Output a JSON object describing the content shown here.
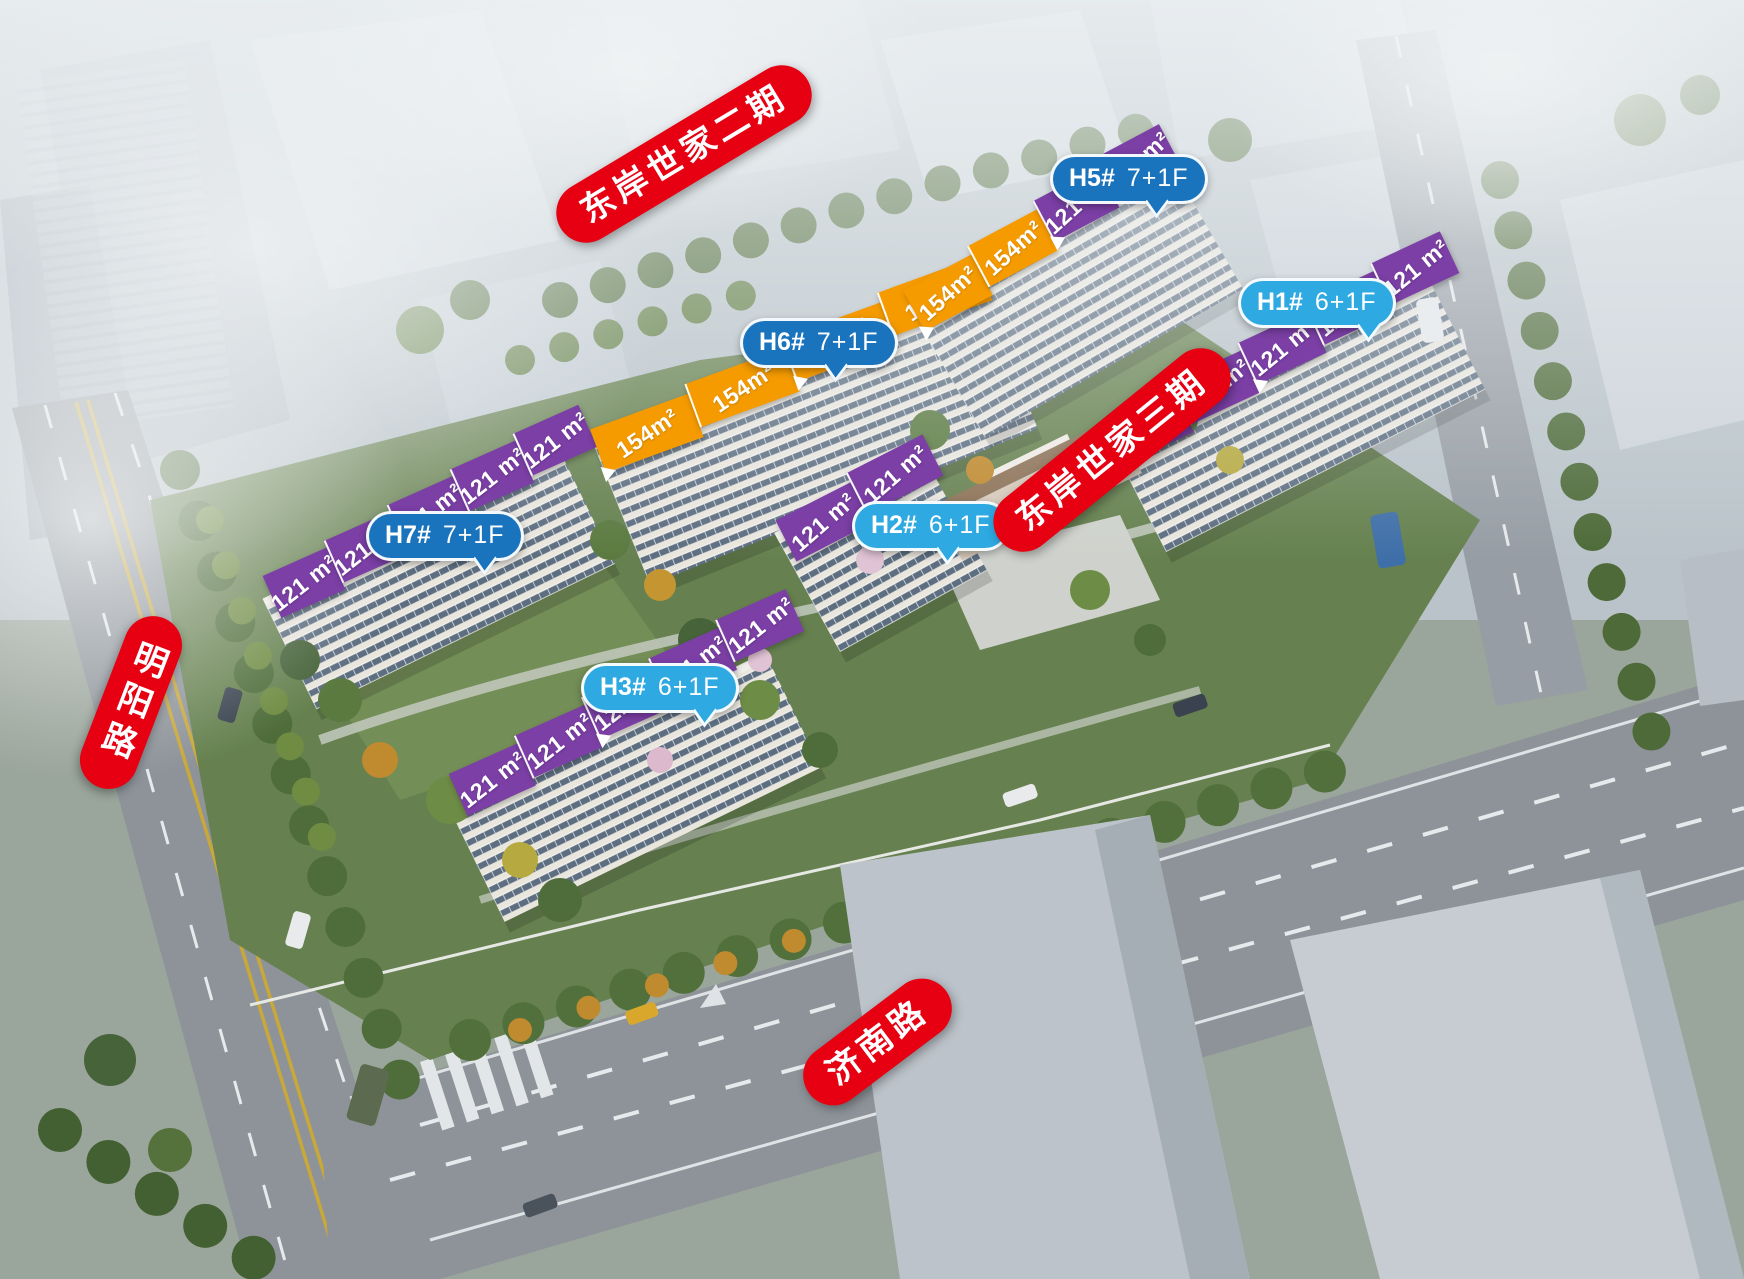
{
  "phase_labels": {
    "phase2": "东岸世家二期",
    "phase3": "东岸世家三期"
  },
  "road_labels": {
    "mingyang": "明阳路",
    "jinan": "济南路"
  },
  "buildings": {
    "h5": {
      "id": "H5#",
      "floors": "7+1F",
      "units": [
        "154m²",
        "154m²",
        "121 m²",
        "121 m²"
      ]
    },
    "h6": {
      "id": "H6#",
      "floors": "7+1F",
      "units": [
        "154m²",
        "154m²",
        "154m²",
        "154m²"
      ]
    },
    "h1": {
      "id": "H1#",
      "floors": "6+1F",
      "units": [
        "121 m²",
        "121 m²",
        "121 m²",
        "121 m²",
        "121 m²"
      ]
    },
    "h7": {
      "id": "H7#",
      "floors": "7+1F",
      "units": [
        "121 m²",
        "121 m²",
        "121 m²",
        "121 m²",
        "121 m²"
      ]
    },
    "h2": {
      "id": "H2#",
      "floors": "6+1F",
      "units": [
        "121 m²",
        "121 m²"
      ]
    },
    "h3": {
      "id": "H3#",
      "floors": "6+1F",
      "units": [
        "121 m²",
        "121 m²",
        "121 m²",
        "121 m²",
        "121 m²"
      ]
    }
  },
  "colors": {
    "label_red": "#e60012",
    "bubble_dark_blue": "#1a73bd",
    "bubble_light_blue": "#2ea9e2",
    "banner_orange": "#f59b00",
    "banner_purple": "#7b3fa5"
  }
}
